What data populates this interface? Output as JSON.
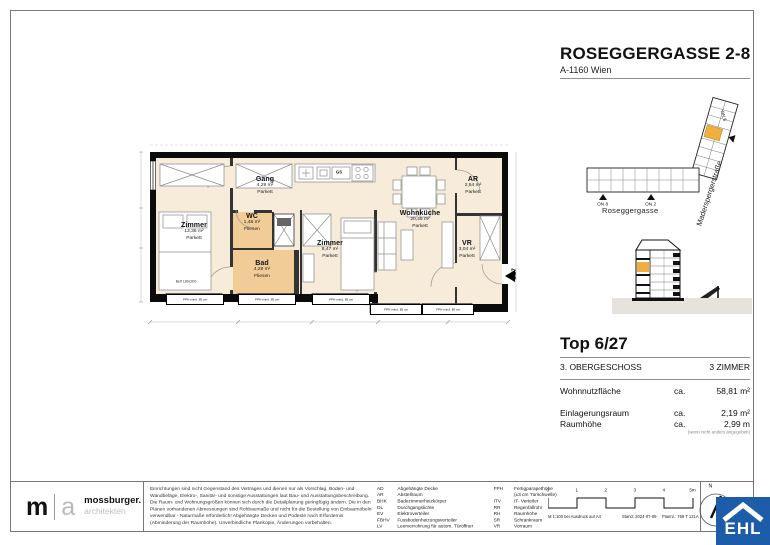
{
  "colors": {
    "floor_cream": "#f6ecd9",
    "wet_room": "#f2cc97",
    "highlight_orange": "#efae3e",
    "ehl_blue": "#1c5ca8",
    "ground_gray": "#e6e3dd"
  },
  "header": {
    "title": "ROSEGGERGASSE 2-8",
    "subtitle": "A-1160 Wien"
  },
  "site_plan": {
    "street_side": "Maderspergerstraße",
    "street_bottom": "Roseggergasse",
    "marker_on8": "ON 8",
    "marker_on2": "ON 2",
    "marker_on6": "ON 6"
  },
  "unit_info": {
    "top": "Top 6/27",
    "floor": "3. OBERGESCHOSS",
    "room_count": "3 ZIMMER",
    "metrics": [
      {
        "label": "Wohnnutzfläche",
        "ca": "ca.",
        "value": "58,81 m²"
      },
      {
        "label": "Einlagerungsraum",
        "ca": "ca.",
        "value": "2,19 m²"
      },
      {
        "label": "Raumhöhe",
        "ca": "ca.",
        "value": "2,99 m"
      }
    ],
    "note": "(wenn nicht anders angegeben)"
  },
  "floor_plan": {
    "rooms": [
      {
        "name": "Zimmer",
        "area": "13,36 m²",
        "finish": "Parkett"
      },
      {
        "name": "Gang",
        "area": "4,29 m²",
        "finish": "Parkett"
      },
      {
        "name": "WC",
        "area": "1,48 m²",
        "finish": "Fliesen"
      },
      {
        "name": "Bad",
        "area": "4,28 m²",
        "finish": "Fliesen"
      },
      {
        "name": "Zimmer",
        "area": "8,47 m²",
        "finish": "Parkett"
      },
      {
        "name": "Wohnküche",
        "area": "20,45 m²",
        "finish": "Parkett"
      },
      {
        "name": "AR",
        "area": "2,54 m²",
        "finish": "Parkett"
      },
      {
        "name": "VR",
        "area": "3,04 m²",
        "finish": "Parkett"
      }
    ],
    "bed_label": "Bett 180x200",
    "dishwasher_label": "GS",
    "window_label": "FPH mind. 85 cm",
    "entry_label": "6/27"
  },
  "footer": {
    "architect": {
      "m": "m",
      "a": "a",
      "name": "mossburger.",
      "tagline": "architekten"
    },
    "disclaimer": "Einrichtungen sind nicht Gegenstand des Vertrages und dienen nur als Vorschlag. Boden- und Wandbeläge, Elektro-, Sanitär- und sonstige Ausstattungen laut Bau- und Ausstattungsbeschreibung. Die Raum- und Wohnungsgrößen können sich durch die Detailplanung geringfügig ändern. Die in den Plänen vorhandenen Abmessungen sind Rohbaumaße und nicht für die Bestellung von Einbaumöbeln verwendbar - Naturmaße erforderlich! Abgehängte Decken und Podeste nach Erfordernis (Abminderung der Raumhöhe). Unverbindliche Plankopie, Änderungen vorbehalten.",
    "legend_col1": [
      {
        "abbr": "AD",
        "desc": "Abgehängte Decke"
      },
      {
        "abbr": "AR",
        "desc": "Abstellraum"
      },
      {
        "abbr": "BHK",
        "desc": "Badezimmerheizkörper"
      },
      {
        "abbr": "DL",
        "desc": "Durchgangslichte"
      },
      {
        "abbr": "EV",
        "desc": "Elektroverteiler"
      },
      {
        "abbr": "FBHV",
        "desc": "Fussbodenheizungsverteiler"
      },
      {
        "abbr": "LV",
        "desc": "Leerverrohrung für autom. Türöffner"
      }
    ],
    "legend_col2": [
      {
        "abbr": "FPH",
        "desc": "Fertigparapethöhe"
      },
      {
        "abbr": "",
        "desc": "(±3 cm Türschwelle)"
      },
      {
        "abbr": "ITV",
        "desc": "IT- Verteiler"
      },
      {
        "abbr": "RR",
        "desc": "Regenfallrohr"
      },
      {
        "abbr": "RH",
        "desc": "Raumhöhe"
      },
      {
        "abbr": "SR",
        "desc": "Schrankraum"
      },
      {
        "abbr": "VR",
        "desc": "Vorraum"
      }
    ],
    "scale_ticks": [
      "0",
      "1",
      "2",
      "3",
      "4",
      "5m"
    ],
    "print_scale": "M 1:100 bei Ausdruck auf A4",
    "print_date": "Stand: 2024-07-09",
    "print_plan_no": "Plannr.: 769 T 121A",
    "north_label": "N",
    "ehl_logo": "EHL"
  }
}
